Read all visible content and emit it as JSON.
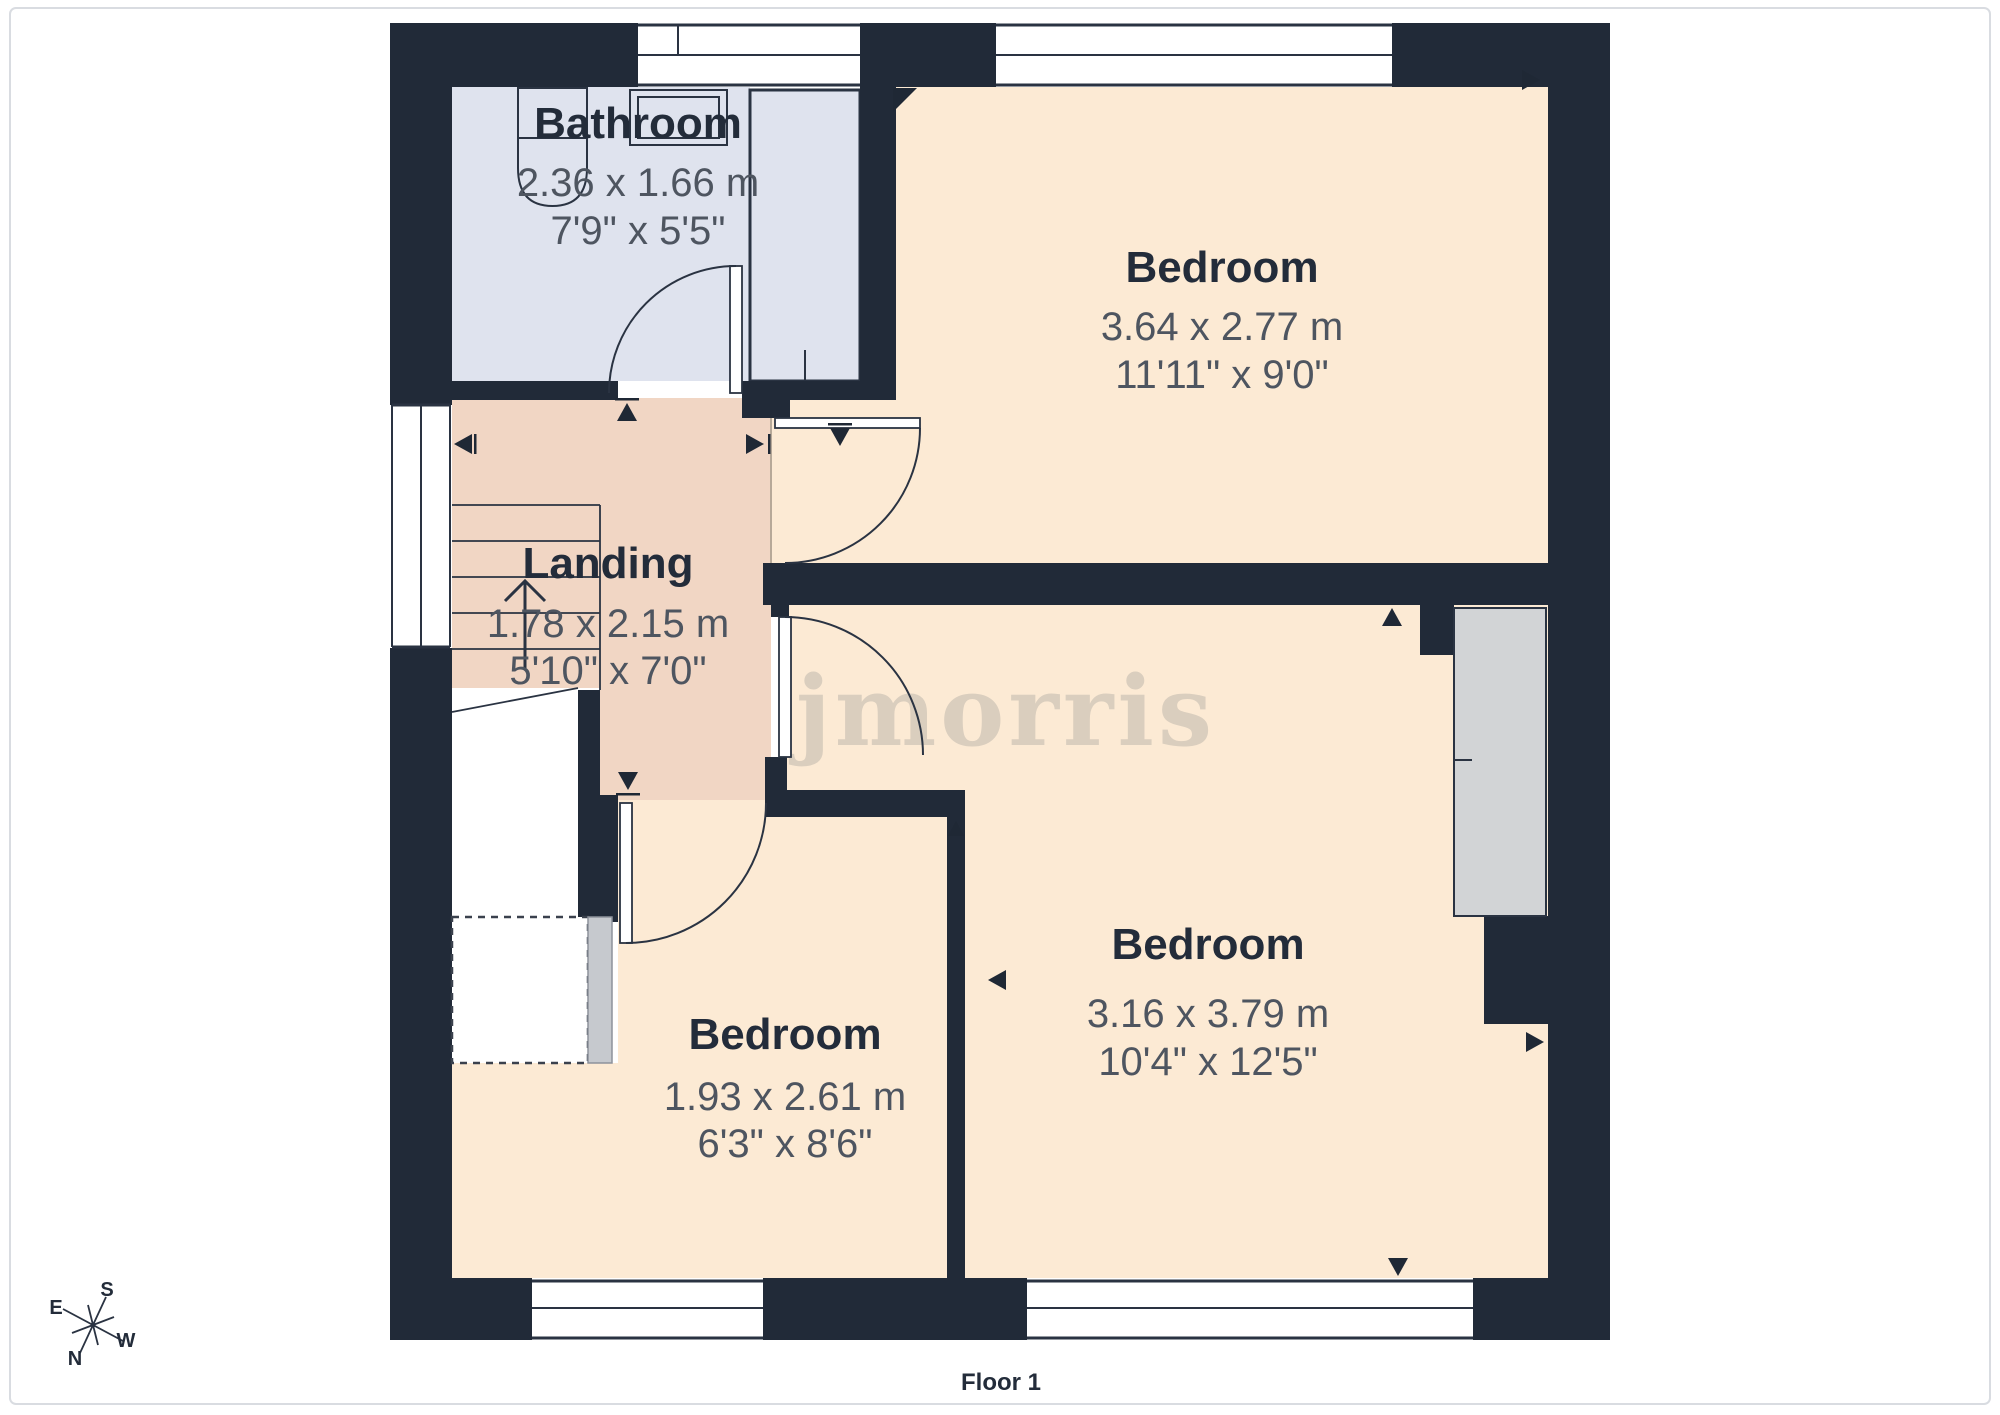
{
  "meta": {
    "floor_label": "Floor 1",
    "watermark": "jmorris"
  },
  "colors": {
    "wall": "#212a38",
    "bathroom_fill": "#dfe3ee",
    "landing_fill": "#f1d6c4",
    "bedroom_fill": "#fcead4",
    "wardrobe_fill": "#d2d4d6",
    "dim_text": "#4e5560",
    "title_text": "#232c3a",
    "watermark_gray": "#969492"
  },
  "rooms": [
    {
      "id": "bathroom",
      "name": "Bathroom",
      "dim_m": "2.36 x 1.66 m",
      "dim_ft": "7'9\" x 5'5\""
    },
    {
      "id": "bedroom-top",
      "name": "Bedroom",
      "dim_m": "3.64 x 2.77 m",
      "dim_ft": "11'11\" x 9'0\""
    },
    {
      "id": "landing",
      "name": "Landing",
      "dim_m": "1.78 x 2.15 m",
      "dim_ft": "5'10\" x 7'0\""
    },
    {
      "id": "bedroom-right",
      "name": "Bedroom",
      "dim_m": "3.16 x 3.79 m",
      "dim_ft": "10'4\" x 12'5\""
    },
    {
      "id": "bedroom-small",
      "name": "Bedroom",
      "dim_m": "1.93 x 2.61 m",
      "dim_ft": "6'3\" x 8'6\""
    }
  ],
  "compass": {
    "n": "N",
    "s": "S",
    "e": "E",
    "w": "W"
  }
}
